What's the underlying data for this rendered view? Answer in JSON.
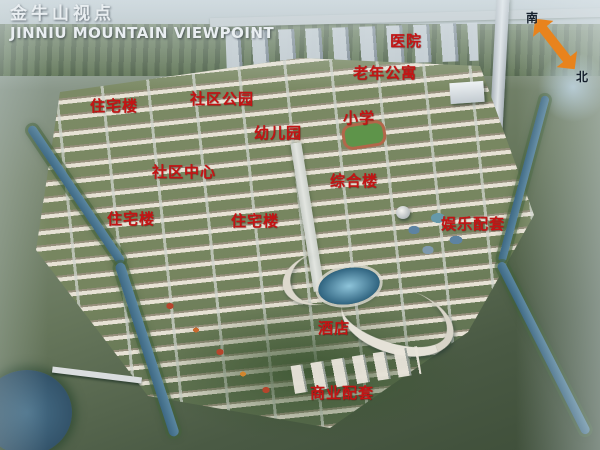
{
  "header": {
    "title_cn": "金牛山视点",
    "title_en": "JINNIU MOUNTAIN VIEWPOINT"
  },
  "compass": {
    "south_label": "南",
    "north_label": "北",
    "arrow_color": "#e8831d"
  },
  "labels": [
    {
      "text": "医院"
    },
    {
      "text": "老年公寓"
    },
    {
      "text": "社区公园"
    },
    {
      "text": "住宅楼"
    },
    {
      "text": "小学"
    },
    {
      "text": "幼儿园"
    },
    {
      "text": "社区中心"
    },
    {
      "text": "综合楼"
    },
    {
      "text": "住宅楼"
    },
    {
      "text": "住宅楼"
    },
    {
      "text": "娱乐配套"
    },
    {
      "text": "酒店"
    },
    {
      "text": "商业配套"
    }
  ],
  "colors": {
    "label_red": "#c41414",
    "title_white": "#e9eef1",
    "compass_text": "#16202c"
  }
}
